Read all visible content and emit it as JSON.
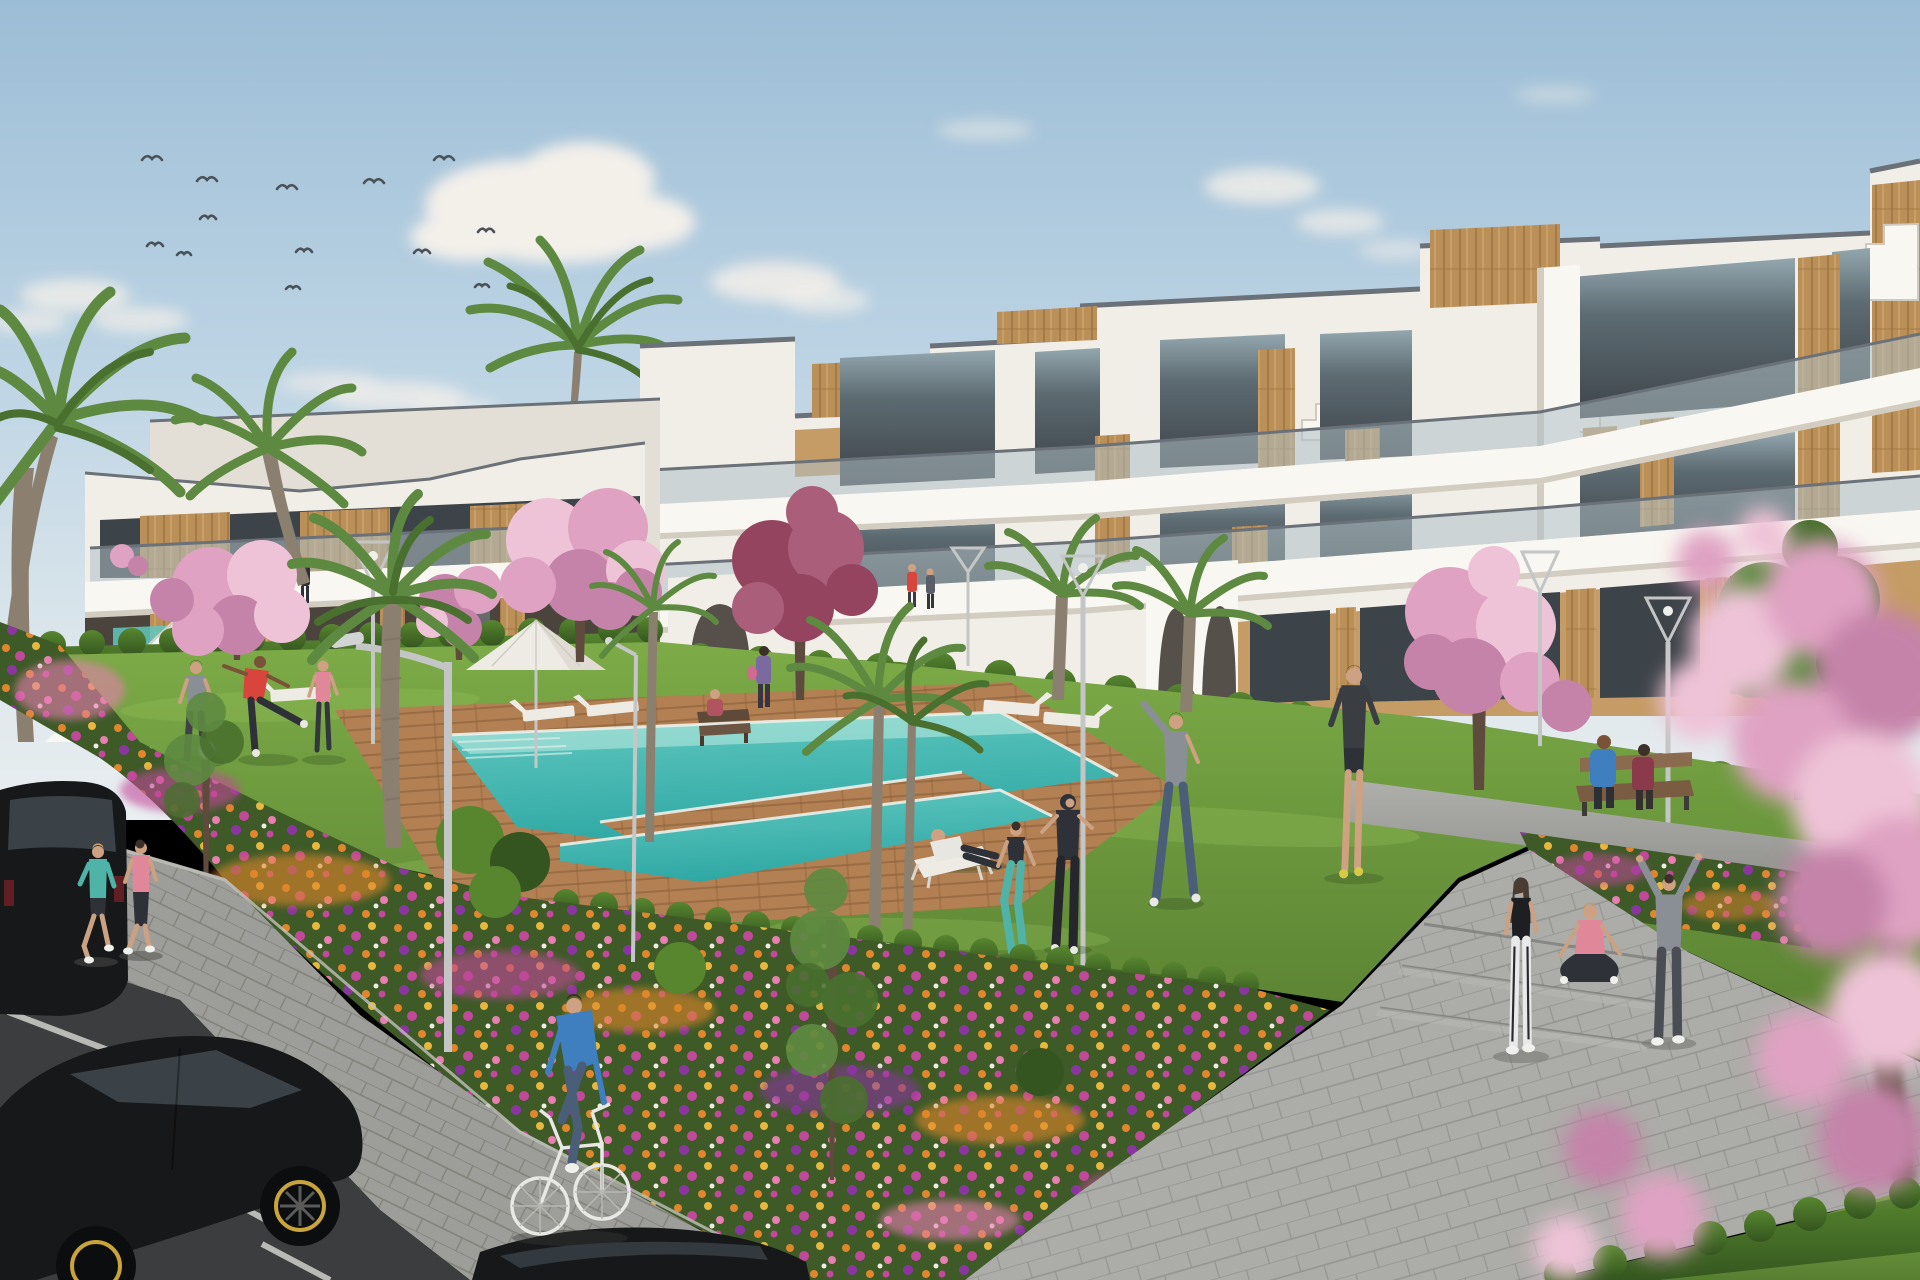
{
  "scene": {
    "title": "Sunny 3D architectural render: white resort-style apartment complex with communal garden, swimming pool and residents outdoors",
    "setting": "modern white apartment buildings with wood cladding and glass balconies around a landscaped courtyard",
    "weather": "clear blue sky with scattered soft clouds and a flock of birds",
    "camera": "elevated three-quarter view from the parking area toward the pool garden"
  },
  "counts": {
    "birds": 13,
    "people": 21,
    "palm_trees": 9,
    "blossom_trees": 9,
    "green_trees": 3,
    "street_lamps": 7,
    "sun_loungers": 9,
    "deck_chairs": 1,
    "parasols": 1,
    "benches": 2,
    "cars": 3,
    "swimming_pools": 1
  },
  "people": [
    {
      "activity": "jogging on sidewalk",
      "wearing": "turquoise top, black shorts"
    },
    {
      "activity": "jogging on sidewalk",
      "wearing": "pink top, dark leggings"
    },
    {
      "activity": "riding a white bicycle",
      "wearing": "blue long-sleeve shirt, jeans"
    },
    {
      "activity": "playing football on lawn",
      "wearing": "grey t-shirt"
    },
    {
      "activity": "kicking a football",
      "wearing": "red t-shirt"
    },
    {
      "activity": "playing on lawn",
      "wearing": "pink top, dark leggings"
    },
    {
      "activity": "reclining on deck chair",
      "wearing": "white t-shirt, dark trousers"
    },
    {
      "activity": "stretching",
      "wearing": "black sports top, turquoise leggings"
    },
    {
      "activity": "exercising",
      "wearing": "black tracksuit"
    },
    {
      "activity": "side stretch, arm raised",
      "wearing": "grey t-shirt, jeans"
    },
    {
      "activity": "stretching",
      "wearing": "dark long-sleeve, shorts"
    },
    {
      "activity": "sitting cross-legged",
      "wearing": "navy hoodie, white cap"
    },
    {
      "activity": "child sitting on bench",
      "wearing": "dark red top"
    },
    {
      "activity": "walking with a bag",
      "wearing": "purple outfit"
    },
    {
      "activity": "sitting on bench, couple",
      "wearing": "blue jacket"
    },
    {
      "activity": "sitting on bench, couple",
      "wearing": "dark red top"
    },
    {
      "activity": "standing on walkway",
      "wearing": "black top, white leggings"
    },
    {
      "activity": "sitting on step",
      "wearing": "pink top, black leggings"
    },
    {
      "activity": "arms-up stretch on walkway",
      "wearing": "grey hoodie"
    },
    {
      "activity": "walking near building",
      "wearing": "dark clothes"
    },
    {
      "activity": "strolling by entrance",
      "wearing": "dark clothes"
    }
  ],
  "vehicles": [
    {
      "type": "dark SUV, rear view",
      "detail": "parked far left"
    },
    {
      "type": "black hatchback, side view",
      "detail": "yellow rim accents"
    },
    {
      "type": "black car roof",
      "detail": "bottom center foreground"
    }
  ],
  "landscape": {
    "pool": "turquoise L-shaped pool with wooden deck surround and timber island walkway",
    "flower_beds": "orange, magenta, pink and purple flower drifts on dark green ground",
    "hedges": "clipped green hedgerows along building bases and walkway edges",
    "foreground": "pink cherry-blossom branches, bottom right, out of focus"
  },
  "palette": {
    "sky-top": "#9cbdd6",
    "sky-mid": "#bdd4e4",
    "sky-low": "#dde7ec",
    "horizon": "#e9eef0",
    "cloud": "#f3efe9",
    "bird": "#4a5258",
    "bldg-white": "#f1eee8",
    "bldg-bright": "#f9f7f2",
    "bldg-shade": "#e4dfd6",
    "bldg-shadow": "#d3ccc1",
    "coping": "#6b7178",
    "tan-wall": "#c59c66",
    "tan-dark": "#a87f4e",
    "wood": "#bb8f58",
    "wood-dark": "#9c7342",
    "wood-light": "#cda26b",
    "glass-dark": "#3d4449",
    "glass-mid": "#5d6b72",
    "glass-sky": "#93a6ae",
    "balustrade": "#aebfc5",
    "hedge-hi": "#57862f",
    "hedge-lo": "#34551f",
    "grass-hi": "#7cab47",
    "grass-lo": "#587f31",
    "grass-streak": "#9cc45e",
    "shadow-green": "#2f4d20",
    "deck": "#b28052",
    "deck-dark": "#8a5f3a",
    "pool-deep": "#2fa8a4",
    "pool-mid": "#62c8c0",
    "pool-light": "#b8e8de",
    "pool-lip": "#eef0ea",
    "path-hi": "#aeaeaa",
    "path-lo": "#8e8e8a",
    "paver-line": "#77777300",
    "road": "#3b3d3f",
    "road-line": "#cfd0ca",
    "flower-base": "#3d5a27",
    "fl-orange": "#e0862c",
    "fl-magenta": "#c2489a",
    "fl-pink": "#e77fb0",
    "fl-purple": "#8a35a0",
    "fl-yellow": "#e8b83e",
    "blossom": "#dfa2c2",
    "blossom-hi": "#eec3d7",
    "blossom-lo": "#c583a9",
    "tree-red": "#94445f",
    "tree-red-hi": "#aa5e79",
    "leaf-green": "#5d8a40",
    "leaf-dark": "#49702f",
    "trunk": "#8b8070",
    "trunk-dark": "#5f4a3e",
    "lamp": "#c4c6c6",
    "white-obj": "#edebe4",
    "skin": "#cfa183",
    "skin-dark": "#7a5238",
    "hair-blonde": "#c79c62",
    "hair-dark": "#3c3128",
    "teal-wear": "#4fb3a8",
    "pink-wear": "#e0879a",
    "red-wear": "#d8453c",
    "blue-wear": "#3f7fc0",
    "navy-wear": "#2e3138",
    "gray-wear": "#8a8f96",
    "denim": "#4a5e78",
    "white-wear": "#e9e9ea",
    "car-body": "#17181a",
    "car-glass": "#3a4248",
    "rim-yellow": "#c8a43a"
  }
}
